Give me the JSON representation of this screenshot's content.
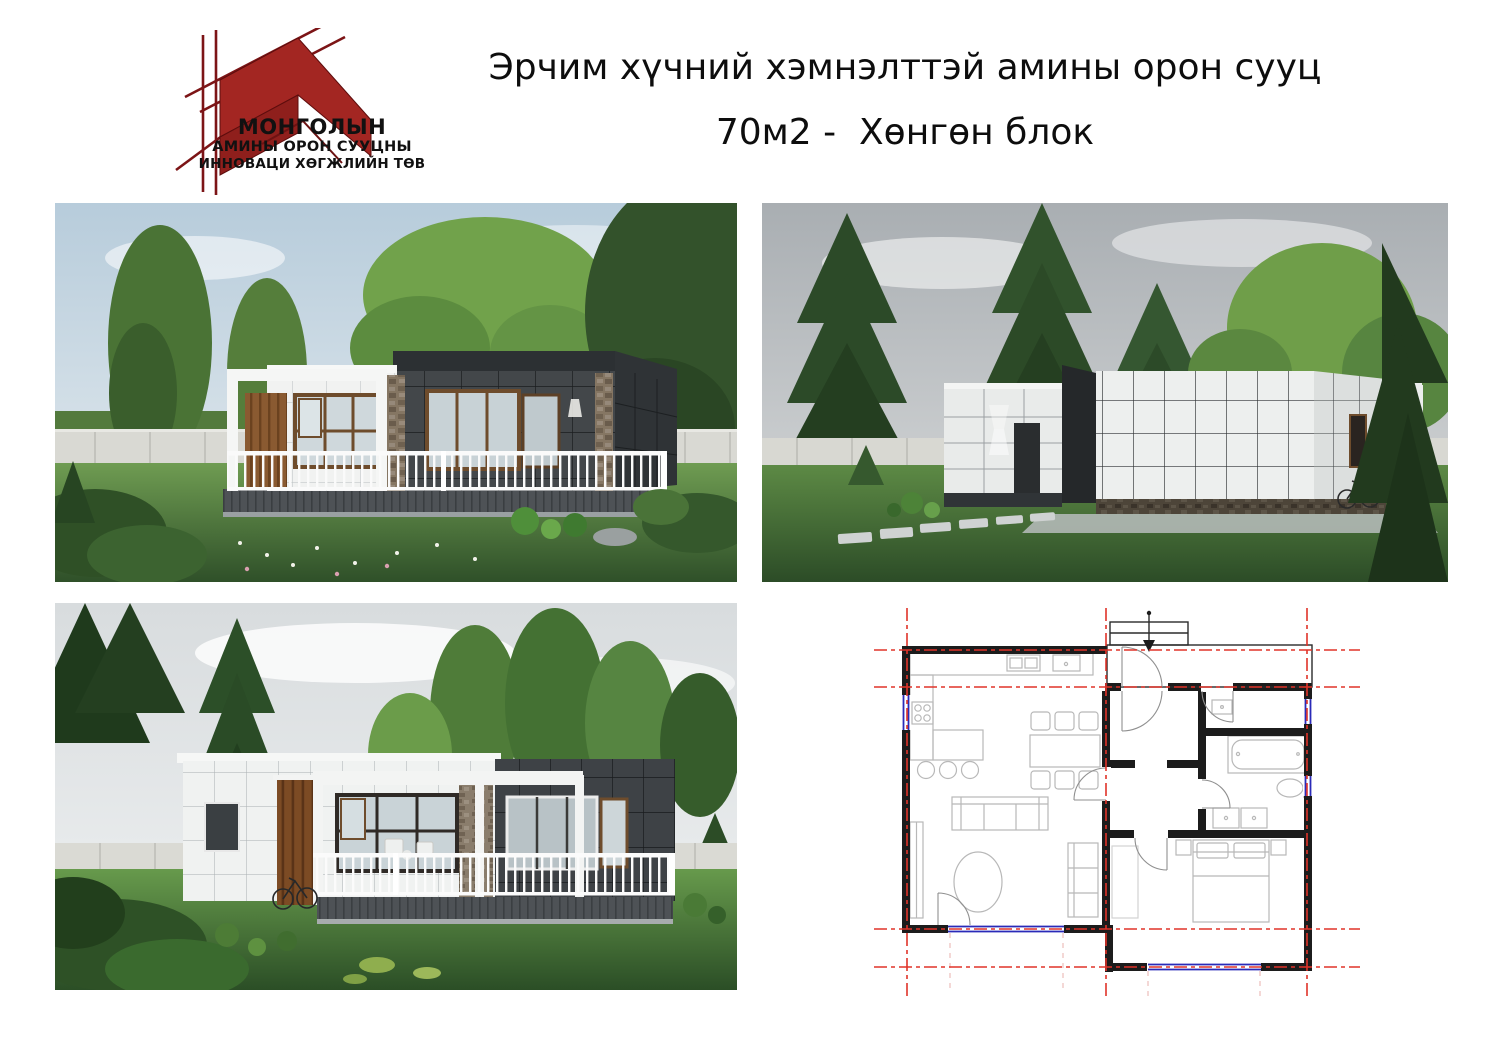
{
  "page": {
    "background": "#ffffff"
  },
  "logo": {
    "brand_color": "#a32622",
    "line_color": "#7c1416",
    "text_lines": [
      "МОНГОЛЫН",
      "АМИНЫ ОРОН СУУЦНЫ",
      "ИННОВАЦИ ХӨГЖЛИЙН ТӨВ"
    ]
  },
  "header": {
    "title_line1": "Эрчим хүчний хэмнэлттэй амины орон сууц",
    "title_line2": "70м2 -  Хөнгөн блок"
  },
  "gallery": {
    "renders": [
      {
        "id": "render-terrace-side",
        "description": "Exterior 3D render — white and dark grey flat-roof house with pergola, terrace and white railing in a green garden"
      },
      {
        "id": "render-entrance-side",
        "description": "Exterior 3D render — entrance facade with white panel cladding, dark accent slab and stepping-stone path"
      },
      {
        "id": "render-terrace-front",
        "description": "Exterior 3D render — terrace front with white railing, wood slat column, stone chimney and dark grey volume"
      }
    ],
    "floor_plan": {
      "id": "floor-plan",
      "description": "Architectural floor plan of the 70 m² house: living/kitchen room, hall, bathroom and bedroom with entrance porch",
      "wall_color": "#1c1c1c",
      "axis_color": "#e03329",
      "window_color": "#2a2ab8",
      "furniture_color": "#b8b8b8"
    }
  }
}
